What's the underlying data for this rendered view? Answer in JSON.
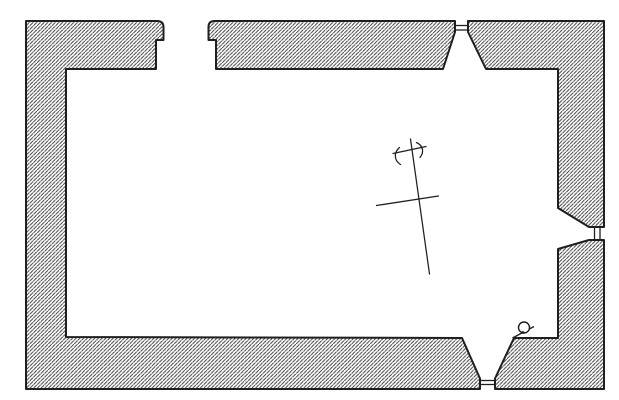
{
  "canvas": {
    "width": 619,
    "height": 400,
    "type_label": "architectural-floor-plan"
  },
  "colors": {
    "paper": "#ffffff",
    "ink": "#1f1f1f",
    "hatch_line": "#474747"
  },
  "hatch": {
    "direction": "diagonal-rising-right",
    "spacing_px": 3.7,
    "line_width_px": 1.05
  },
  "plan": {
    "wall_segments": [
      {
        "name": "wall-segment-west-and-southwest",
        "d": "M480,389 L26,389 L26,21 L157,21 Q163.5,21 163.5,27 L163.5,40 L156,40 L156,69 L66,69 L66,337 L462,338 L480,378.5 Z"
      },
      {
        "name": "wall-segment-north-middle",
        "d": "M216,69 L216,40 L208.5,40 L208.5,27 Q208.5,21 214.5,21 L455,21 L455,32 L443,69 Z"
      },
      {
        "name": "wall-segment-northeast",
        "d": "M468,21 L604,21 L604,227 L589,227 L558,208 L558,69 L486,69 L468,32 Z"
      },
      {
        "name": "wall-segment-southeast",
        "d": "M604,240 L604,389 L495,389 L495,378.5 L514,338 L558,338 L558,249 L589,240 Z"
      }
    ],
    "doorway": {
      "name": "north-doorway-opening",
      "outer_gap": [
        163.5,
        208.5
      ],
      "inner_gap": [
        156,
        216
      ]
    },
    "window_frames": [
      {
        "name": "north-window-frame-lines",
        "lines": [
          "M455,25.5 L468,25.5",
          "M455,30 L468,30"
        ]
      },
      {
        "name": "east-window-frame-lines",
        "lines": [
          "M594.5,227 L594.5,240",
          "M600,227 L600,240"
        ]
      },
      {
        "name": "south-window-frame-lines",
        "lines": [
          "M480,380.5 L495,380.5",
          "M480,384.5 L495,384.5"
        ]
      }
    ],
    "cross_mark": {
      "strokes": [
        {
          "name": "cross-staff-line",
          "d": "M410.5,139 L429.5,274"
        },
        {
          "name": "cross-upper-bar",
          "d": "M393,153.5 L426,146.5"
        },
        {
          "name": "cross-lower-bar",
          "d": "M376.5,205.5 L438.5,196"
        },
        {
          "name": "cross-left-arc",
          "d": "M399.5,147.5 C394,152 393.5,160 400.5,164.5"
        },
        {
          "name": "cross-right-arc",
          "d": "M416.5,142.5 C423,145.5 424.5,152 420,157.5"
        }
      ]
    },
    "stoup": {
      "name": "stoup-detail",
      "slash_d": "M512.5,338 L534,326.5",
      "circle": {
        "cx": 524,
        "cy": 327.5,
        "r": 5.5
      },
      "dot": {
        "cx": 523,
        "cy": 332.5,
        "r": 1.4
      }
    }
  }
}
